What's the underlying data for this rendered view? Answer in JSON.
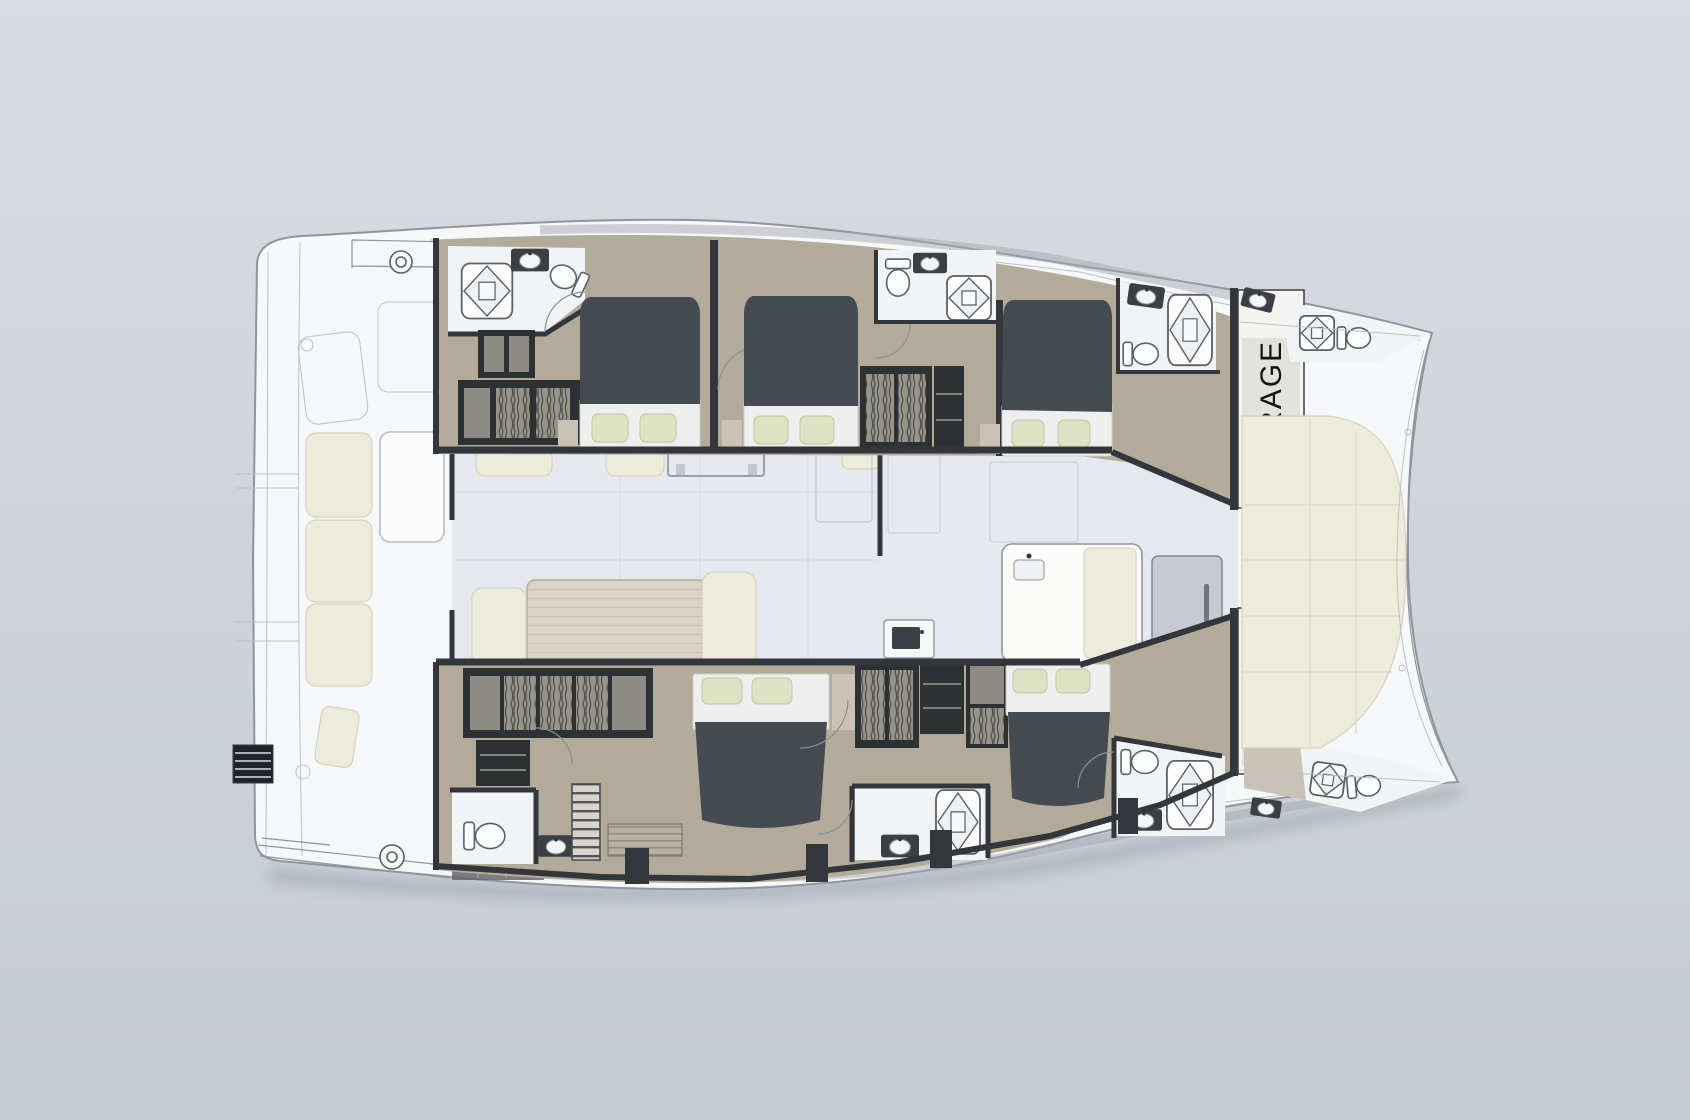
{
  "labels": {
    "storage_starboard": "STORAGE",
    "storage_port": "STORAGE"
  },
  "colors": {
    "bg_top": "#d9dce1",
    "bg_bottom": "#c6cad2",
    "deck": "#f6f7f8",
    "deck_line": "#8f959d",
    "deck_line_soft": "#bcc1c8",
    "walkway": "#a3a8b0",
    "hull_floor": "#b2ab9a",
    "hull_floor_light": "#c9c3b5",
    "wall": "#33373b",
    "cabinet": "#2e3134",
    "cabinet_slot": "#8e8b84",
    "duvet": "#464b52",
    "sheet": "#edeeed",
    "pillow": "#dde3c2",
    "cream": "#edecdb",
    "saloon_floor": "#e7e8ee",
    "wood": "#d8d2c5",
    "fixture": "#fafbfb",
    "fixture_line": "#5b6066",
    "storage_box": "#f3f3f0",
    "storage_text": "#141414"
  }
}
